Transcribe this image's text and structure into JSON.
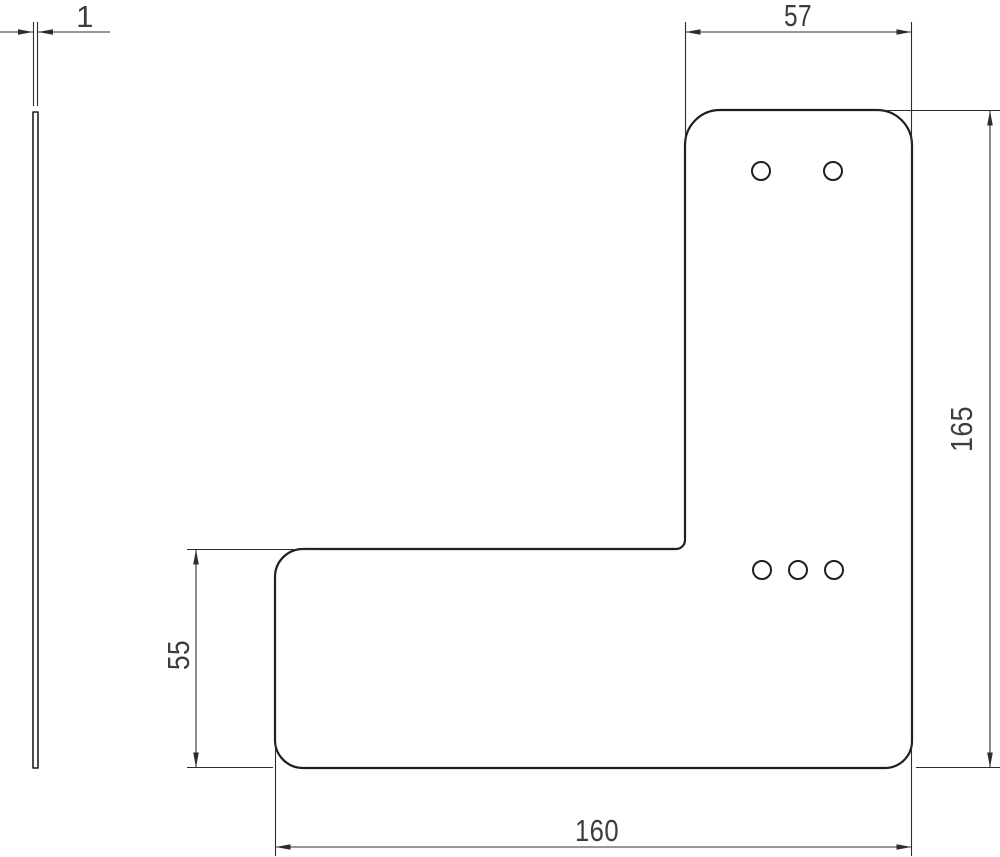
{
  "page": {
    "background": "#ffffff"
  },
  "drawing": {
    "type": "technical-2d-drawing",
    "labels": {
      "thickness": "1",
      "top_width": "57",
      "overall_height": "165",
      "step_height": "55",
      "bottom_width": "160"
    },
    "colors": {
      "outline": "#1f1f1f",
      "dimension": "#2d2d2d",
      "label": "#3d3d3d",
      "fill": "#ffffff"
    },
    "views": {
      "front": {
        "shape": "L-plate-rounded-corners",
        "holes_top": 2,
        "holes_bottom": 3
      },
      "side": {
        "shape": "thin-vertical-strip"
      }
    }
  }
}
